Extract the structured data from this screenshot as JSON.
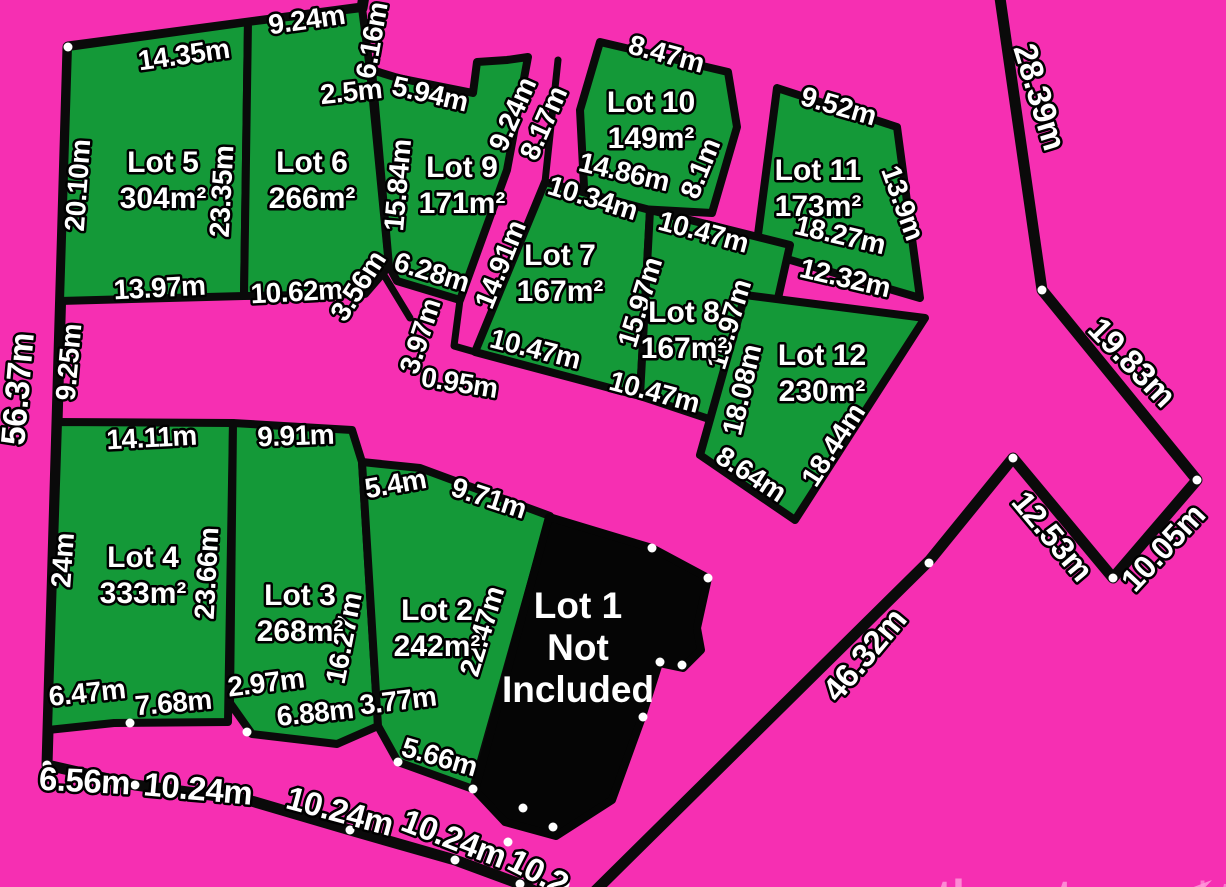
{
  "plan_title": "Residential subdivision lot plan",
  "colors": {
    "background": "#F62FB2",
    "land": "#149938",
    "boundary": "#0A0A0A",
    "excluded_lot_fill": "#050505",
    "vertex_dot": "#FFFFFF",
    "label_fill": "#FFFFFF",
    "label_outline": "#000000",
    "watermark": "#FF9BDA"
  },
  "lots": [
    {
      "name": "Lot 5",
      "area": "304m²",
      "cx": 163,
      "cy": 172
    },
    {
      "name": "Lot 6",
      "area": "266m²",
      "cx": 312,
      "cy": 172
    },
    {
      "name": "Lot 9",
      "area": "171m²",
      "cx": 462,
      "cy": 177
    },
    {
      "name": "Lot 10",
      "area": "149m²",
      "cx": 651,
      "cy": 112
    },
    {
      "name": "Lot 11",
      "area": "173m²",
      "cx": 818,
      "cy": 180
    },
    {
      "name": "Lot 7",
      "area": "167m²",
      "cx": 560,
      "cy": 265
    },
    {
      "name": "Lot 8",
      "area": "167m²",
      "cx": 684,
      "cy": 322
    },
    {
      "name": "Lot 12",
      "area": "230m²",
      "cx": 822,
      "cy": 365
    },
    {
      "name": "Lot 4",
      "area": "333m²",
      "cx": 143,
      "cy": 567
    },
    {
      "name": "Lot 3",
      "area": "268m²",
      "cx": 300,
      "cy": 605
    },
    {
      "name": "Lot 2",
      "area": "242m²",
      "cx": 437,
      "cy": 620
    }
  ],
  "excluded_lot": {
    "lines": [
      "Lot 1",
      "Not",
      "Included"
    ],
    "cx": 578,
    "cy": 618,
    "line_height": 42
  },
  "measurements": [
    {
      "t": "14.35m",
      "x": 185,
      "y": 64,
      "r": -8,
      "s": 28
    },
    {
      "t": "9.24m",
      "x": 308,
      "y": 29,
      "r": -8,
      "s": 28
    },
    {
      "t": "2.5m",
      "x": 352,
      "y": 101,
      "r": -6,
      "s": 28
    },
    {
      "t": "6.16m",
      "x": 381,
      "y": 42,
      "r": -80,
      "s": 28
    },
    {
      "t": "5.94m",
      "x": 428,
      "y": 103,
      "r": 13,
      "s": 28
    },
    {
      "t": "20.10m",
      "x": 87,
      "y": 186,
      "r": -86,
      "s": 28
    },
    {
      "t": "23.35m",
      "x": 231,
      "y": 192,
      "r": -87,
      "s": 28
    },
    {
      "t": "15.84m",
      "x": 407,
      "y": 186,
      "r": -85,
      "s": 28
    },
    {
      "t": "13.97m",
      "x": 160,
      "y": 297,
      "r": -3,
      "s": 28
    },
    {
      "t": "10.62m",
      "x": 297,
      "y": 301,
      "r": -3,
      "s": 28
    },
    {
      "t": "3.56m",
      "x": 366,
      "y": 291,
      "r": -57,
      "s": 28
    },
    {
      "t": "6.28m",
      "x": 429,
      "y": 281,
      "r": 17,
      "s": 28
    },
    {
      "t": "9.24m",
      "x": 521,
      "y": 118,
      "r": -66,
      "s": 28
    },
    {
      "t": "8.17m",
      "x": 552,
      "y": 127,
      "r": -66,
      "s": 28
    },
    {
      "t": "14.91m",
      "x": 509,
      "y": 268,
      "r": -68,
      "s": 28
    },
    {
      "t": "10.34m",
      "x": 590,
      "y": 207,
      "r": 17,
      "s": 28
    },
    {
      "t": "10.47m",
      "x": 533,
      "y": 358,
      "r": 14,
      "s": 28
    },
    {
      "t": "15.97m",
      "x": 649,
      "y": 305,
      "r": -73,
      "s": 28
    },
    {
      "t": "15.97m",
      "x": 738,
      "y": 327,
      "r": -73,
      "s": 28
    },
    {
      "t": "10.47m",
      "x": 701,
      "y": 241,
      "r": 15,
      "s": 28
    },
    {
      "t": "10.47m",
      "x": 652,
      "y": 401,
      "r": 15,
      "s": 28
    },
    {
      "t": "3.97m",
      "x": 429,
      "y": 339,
      "r": -72,
      "s": 28
    },
    {
      "t": "0.95m",
      "x": 458,
      "y": 392,
      "r": 9,
      "s": 28
    },
    {
      "t": "8.47m",
      "x": 664,
      "y": 63,
      "r": 15,
      "s": 28
    },
    {
      "t": "14.86m",
      "x": 622,
      "y": 181,
      "r": 13,
      "s": 28
    },
    {
      "t": "8.1m",
      "x": 709,
      "y": 172,
      "r": -68,
      "s": 28
    },
    {
      "t": "9.52m",
      "x": 836,
      "y": 115,
      "r": 16,
      "s": 28
    },
    {
      "t": "13.9m",
      "x": 894,
      "y": 206,
      "r": 70,
      "s": 28
    },
    {
      "t": "18.27m",
      "x": 838,
      "y": 244,
      "r": 13,
      "s": 28
    },
    {
      "t": "12.32m",
      "x": 843,
      "y": 287,
      "r": 13,
      "s": 28
    },
    {
      "t": "18.08m",
      "x": 751,
      "y": 392,
      "r": -77,
      "s": 28
    },
    {
      "t": "18.44m",
      "x": 841,
      "y": 450,
      "r": -57,
      "s": 28
    },
    {
      "t": "8.64m",
      "x": 746,
      "y": 482,
      "r": 33,
      "s": 28
    },
    {
      "t": "28.39m",
      "x": 1029,
      "y": 100,
      "r": 73,
      "s": 33
    },
    {
      "t": "19.83m",
      "x": 1124,
      "y": 370,
      "r": 46,
      "s": 33
    },
    {
      "t": "12.53m",
      "x": 1044,
      "y": 543,
      "r": 50,
      "s": 32
    },
    {
      "t": "10.05m",
      "x": 1171,
      "y": 555,
      "r": -47,
      "s": 32
    },
    {
      "t": "46.32m",
      "x": 873,
      "y": 662,
      "r": -50,
      "s": 33
    },
    {
      "t": "56.37m",
      "x": 29,
      "y": 390,
      "r": -85,
      "s": 34
    },
    {
      "t": "9.25m",
      "x": 78,
      "y": 363,
      "r": -85,
      "s": 28
    },
    {
      "t": "14.11m",
      "x": 152,
      "y": 447,
      "r": -3,
      "s": 28
    },
    {
      "t": "9.91m",
      "x": 296,
      "y": 445,
      "r": -2,
      "s": 28
    },
    {
      "t": "24m",
      "x": 72,
      "y": 561,
      "r": -86,
      "s": 28
    },
    {
      "t": "23.66m",
      "x": 216,
      "y": 574,
      "r": -87,
      "s": 28
    },
    {
      "t": "16.27m",
      "x": 353,
      "y": 640,
      "r": -79,
      "s": 28
    },
    {
      "t": "5.4m",
      "x": 397,
      "y": 493,
      "r": -10,
      "s": 28
    },
    {
      "t": "9.71m",
      "x": 486,
      "y": 507,
      "r": 18,
      "s": 28
    },
    {
      "t": "22.47m",
      "x": 491,
      "y": 634,
      "r": -73,
      "s": 28
    },
    {
      "t": "2.97m",
      "x": 267,
      "y": 692,
      "r": -7,
      "s": 28
    },
    {
      "t": "6.88m",
      "x": 316,
      "y": 722,
      "r": -6,
      "s": 28
    },
    {
      "t": "3.77m",
      "x": 399,
      "y": 710,
      "r": -7,
      "s": 28
    },
    {
      "t": "6.47m",
      "x": 88,
      "y": 702,
      "r": -6,
      "s": 28
    },
    {
      "t": "7.68m",
      "x": 174,
      "y": 712,
      "r": -5,
      "s": 28
    },
    {
      "t": "5.66m",
      "x": 437,
      "y": 766,
      "r": 16,
      "s": 28
    },
    {
      "t": "6.56m",
      "x": 84,
      "y": 792,
      "r": 3,
      "s": 33
    },
    {
      "t": "10.24m",
      "x": 197,
      "y": 800,
      "r": 5,
      "s": 33
    },
    {
      "t": "10.24m",
      "x": 337,
      "y": 822,
      "r": 15,
      "s": 33
    },
    {
      "t": "10.24m",
      "x": 450,
      "y": 849,
      "r": 21,
      "s": 33
    },
    {
      "t": "10.2",
      "x": 533,
      "y": 882,
      "r": 27,
      "s": 33
    }
  ],
  "watermark": {
    "brand_bold": "southeast",
    "brand_light": "realty",
    "arrow_icon": "paper-plane-arrow"
  }
}
